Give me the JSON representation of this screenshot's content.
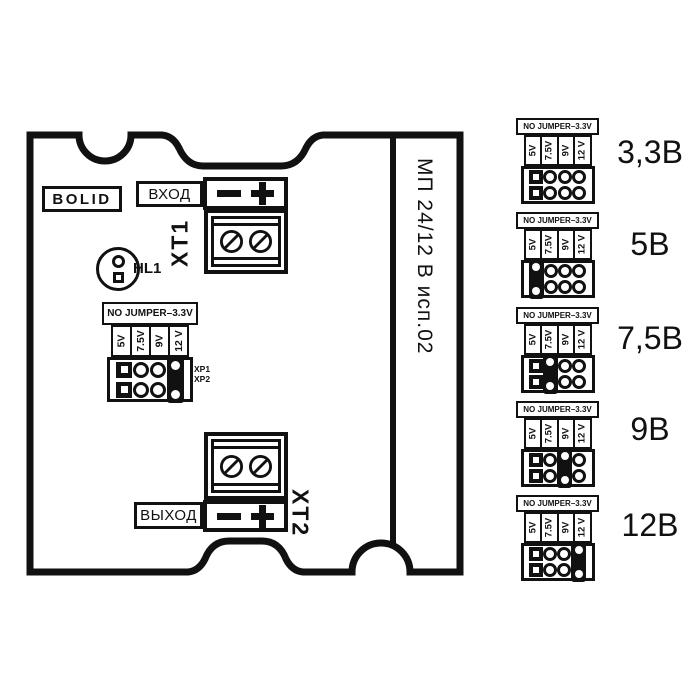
{
  "brand_logo": "BOLID",
  "board": {
    "model_label": "МП 24/12 В исп.02",
    "input_label": "ВХОД",
    "output_label": "ВЫХОД",
    "xt1_label": "XT1",
    "xt2_label": "XT2",
    "hl1_label": "HL1",
    "xp1_label": "XP1",
    "xp2_label": "XP2",
    "board_jumper_position": "12 V"
  },
  "jumper_header": "NO JUMPER–3.3V",
  "jumper_columns": [
    "5V",
    "7.5V",
    "9V",
    "12 V"
  ],
  "voltage_diagrams": [
    {
      "label": "3,3В",
      "jumper": null
    },
    {
      "label": "5В",
      "jumper": "5V"
    },
    {
      "label": "7,5В",
      "jumper": "7.5V"
    },
    {
      "label": "9В",
      "jumper": "9V"
    },
    {
      "label": "12В",
      "jumper": "12 V"
    }
  ],
  "colors": {
    "ink": "#111111",
    "background": "#ffffff"
  }
}
